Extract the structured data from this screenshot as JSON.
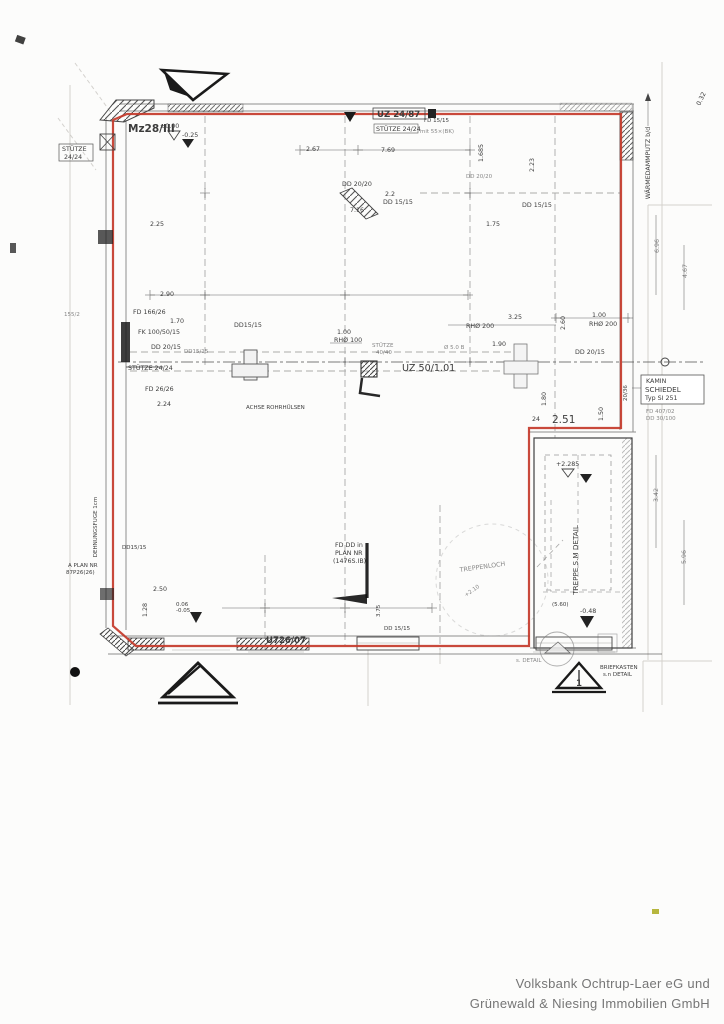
{
  "document": {
    "kind": "scanned structural floor plan"
  },
  "colors": {
    "outline_red": "#c43a2a",
    "ink": "#3c3c3c",
    "footer_gray": "#757575",
    "highlight_yellow": "#b6b63e"
  },
  "footer": {
    "line1": "Volksbank Ochtrup-Laer eG und",
    "line2": "Grünewald & Niesing Immobilien GmbH"
  },
  "labels": {
    "mz28": "Mz28/III",
    "lvl_plus000": "±0.00",
    "lvl_minus025": "-0.25",
    "uz_24_87": "UZ 24/87",
    "stuetze_top": "STÜTZE 24/24",
    "stuetze_top_note": "mit 55×(BK)",
    "fd_15_15_top": "FD 15/15",
    "dim_267": "2.67",
    "dim_769": "7.69",
    "dim_1685": "1.685",
    "dim_223": "2.23",
    "dd_2020_a": "DD 20/20",
    "dim_22": "2.2",
    "dd_1515_a": "DD 15/15",
    "dim_716": "7.16",
    "dd_2020_b": "DD 20/20",
    "dd_1515_b": "DD 15/15",
    "dim_175": "1.75",
    "dim_225": "2.25",
    "stuetze_left_1": "STÜTZE",
    "stuetze_left_2": "24/24",
    "waermedaemmputz": "WÄRMEDAMMPUTZ b/d",
    "dim_032": "0.32",
    "dim_696": "6.96",
    "dim_467": "4.67",
    "dim_290": "2.90",
    "fd_166_26": "FD 166/26",
    "dim_170": "1.70",
    "fk_100_50_15": "FK 100/50/15",
    "dd_2015_a": "DD 20/15",
    "dd_1515_c": "DD15/15",
    "dd_1515_d": "DD15/15",
    "stuetze_mid": "STÜTZE 24/24",
    "fd_26_26": "FD 26/26",
    "dim_155_2": "155/2",
    "achse_rohrhuelsen": "ACHSE ROHRHÜLSEN",
    "dim_224": "2.24",
    "dim_100_l": "1.00",
    "rh_100": "RHØ 100",
    "stuetze_4040_1": "STÜTZE",
    "stuetze_4040_2": "40/40",
    "uz_50": "UZ 50/1.01",
    "rh_200_a": "RHØ 200",
    "dim_325": "3.25",
    "dim_190": "1.90",
    "phi_50": "Ø 5.0 B",
    "dim_260": "2.60",
    "dim_100_r": "1.00",
    "rh_200_b": "RHØ 200",
    "dd_2015_b": "DD 20/15",
    "kamin_1": "KAMIN",
    "kamin_2": "SCHIEDEL",
    "kamin_3": "Typ SI 251",
    "kamin_4": "FD 407/02",
    "kamin_5": "DD 30/100",
    "dim_24": "24",
    "dim_251": "2.51",
    "dim_180": "1.80",
    "dim_150": "1.50",
    "dim_2036": "20/36",
    "lvl_plus2285": "+2.285",
    "treppe_detail": "TREPPE S.M DETAIL",
    "lvl_minus048": "-0.48",
    "dim_560": "(5.60)",
    "dim_342": "3.42",
    "dim_596": "5.96",
    "dehnungsfuge": "DEHNUNGSFUGE 1cm",
    "a_plan_1": "A PLAN NR",
    "a_plan_2": "87P26(26)",
    "dd_1515_e": "DD15/15",
    "dim_250": "2.50",
    "dim_128": "1.28",
    "lvl_006": "0.06",
    "lvl_minus005": "-0.05",
    "fd_plan_1": "FD DD in",
    "fd_plan_2": "PLAN NR",
    "fd_plan_3": "(1476S.IB)",
    "treppenloch": "TREPPENLOCH",
    "lvl_plus210": "+2.10",
    "dim_375": "3.75",
    "dd_1515_f": "DD 15/15",
    "uz_26_07": "U726/07",
    "briefkasten_1": "BRIEFKASTEN",
    "briefkasten_2": "s.n DETAIL",
    "s_detail": "s. DETAIL",
    "section_1": "1"
  }
}
